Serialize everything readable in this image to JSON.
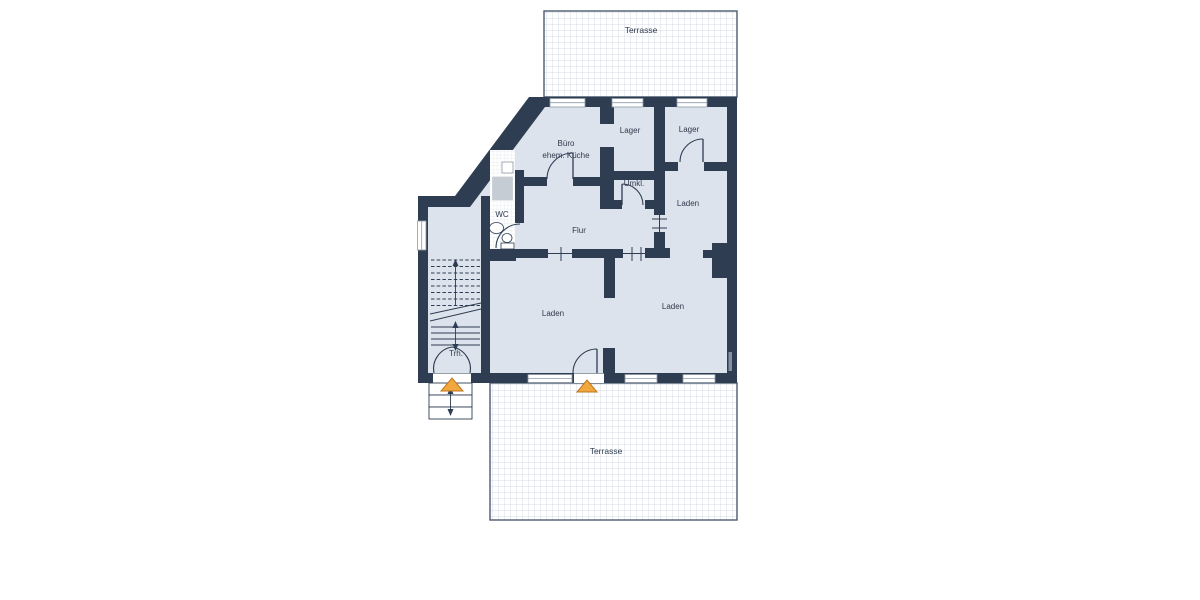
{
  "colors": {
    "background": "#ffffff",
    "wall": "#2e3d52",
    "floor": "#dde3ec",
    "terrace_grid": "#c6d1de",
    "terrace_border": "#4c5b6e",
    "wc_tile": "#dfe4ea",
    "window": "#ffffff",
    "window_stroke": "#8d99a8",
    "shower": "#c6ccd4",
    "entrance_marker": "#f0a73e",
    "entrance_marker_border": "#c2761d",
    "label_text": "#2e3a4c"
  },
  "labels": {
    "terrace_top": "Terrasse",
    "terrace_bottom": "Terrasse",
    "buero_line1": "Büro",
    "buero_line2": "ehem. Küche",
    "lager_left": "Lager",
    "lager_right": "Lager",
    "umkleide": "Umkl.",
    "laden_upper": "Laden",
    "laden_lower_left": "Laden",
    "laden_lower_right": "Laden",
    "wc": "WC",
    "flur": "Flur",
    "treppenhaus": "Trh."
  }
}
